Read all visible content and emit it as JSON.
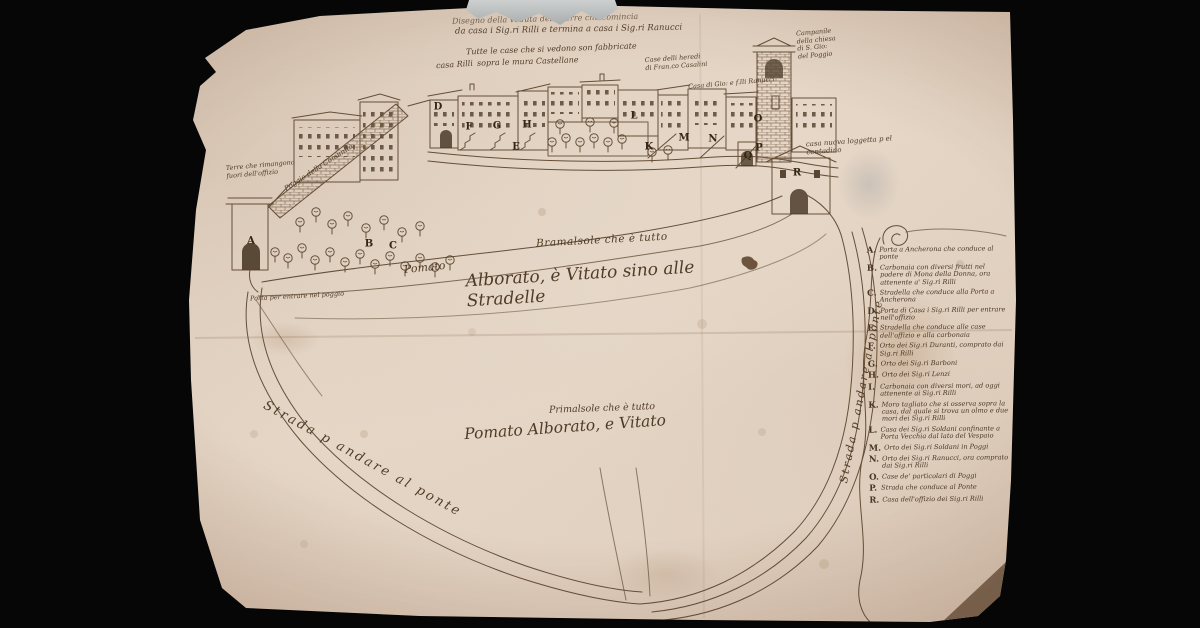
{
  "colors": {
    "background": "#060606",
    "paper": "#e6d8c9",
    "ink": "#5a432c"
  },
  "title": {
    "line1": "Disegno della veduta delle terre che comincia",
    "line2": "da casa i Sig.ri Rilli e termina a casa i Sig.ri Ranucci"
  },
  "annotations": [
    {
      "id": "title-1",
      "text": "Disegno della veduta delle terre che comincia",
      "style": "left:452px;top:13px;width:285px;font-size:8px;transform:rotate(-1.5deg);opacity:.75"
    },
    {
      "id": "title-2",
      "text": "da casa i Sig.ri Rilli e termina a casa i Sig.ri Ranucci",
      "style": "left:455px;top:24px;width:295px;font-size:8.5px;transform:rotate(-1deg)"
    },
    {
      "id": "casa-rilli",
      "text": "casa Rilli",
      "style": "left:436px;top:60px;font-size:8px;transform:rotate(-4deg)"
    },
    {
      "id": "mura-note-1",
      "text": "Tutte le case che si vedono son fabbricate",
      "style": "left:466px;top:44px;width:195px;font-size:8px;transform:rotate(-2deg)"
    },
    {
      "id": "mura-note-2",
      "text": "sopra le mura Castellane",
      "style": "left:477px;top:57px;font-size:8px;transform:rotate(-2deg)"
    },
    {
      "id": "case-heredi",
      "text": "Case delli heredi\ndi Fran.co Casalini",
      "style": "left:645px;top:54px;width:90px;font-size:6.5px;transform:rotate(-4deg)"
    },
    {
      "id": "casa-ranucci",
      "text": "Casa di Gio: e f.lli Ranucci",
      "style": "left:688px;top:78px;width:130px;font-size:6.5px;transform:rotate(-5deg)"
    },
    {
      "id": "campanile-note",
      "text": "Campanile\ndella chiesa\ndi S. Gio:\ndel Poggio",
      "style": "left:797px;top:28px;width:60px;font-size:6.5px;transform:rotate(-5deg)"
    },
    {
      "id": "loggetta-note",
      "text": "casa nuova loggetta p el\ncontadino",
      "style": "left:806px;top:136px;width:125px;font-size:7px;transform:rotate(-4deg)"
    },
    {
      "id": "fuori-note",
      "text": "Terre che rimangono\nfuori dell'offizio",
      "style": "left:226px;top:161px;width:95px;font-size:6.5px;transform:rotate(-5deg)"
    },
    {
      "id": "poggio-note",
      "text": "Poggio della Comunità",
      "style": "left:283px;top:186px;width:115px;font-size:7px;transform:rotate(-33deg);transform-origin:left top"
    },
    {
      "id": "porta-note",
      "text": "Porta per entrare nel poggio",
      "style": "left:250px;top:292px;width:135px;font-size:6.5px;transform:rotate(-3deg)"
    },
    {
      "id": "bramasole",
      "text": "Bramalsole che è tutto",
      "style": "left:536px;top:233px;width:175px;font-size:10.5px;letter-spacing:.5px;transform:rotate(-3deg)"
    },
    {
      "id": "pomato",
      "text": "Pomato",
      "style": "left:404px;top:262px;font-size:11px;transform:rotate(-6deg)"
    },
    {
      "id": "alborato",
      "text": "Alborato, è Vitato sino alle Stradelle",
      "style": "left:466px;top:263px;width:275px;font-size:17px;transform:rotate(-3.5deg)"
    },
    {
      "id": "primalsole",
      "text": "Primalsole che è tutto",
      "style": "left:549px;top:402px;width:160px;font-size:9.5px;transform:rotate(-2deg)"
    },
    {
      "id": "pomato-2",
      "text": "Pomato Alborato, e Vitato",
      "style": "left:464px;top:417px;width:235px;font-size:15.5px;transform:rotate(-4deg)"
    },
    {
      "id": "road-left",
      "text": "Strada p andare al ponte",
      "style": "left:268px;top:398px;width:250px;font-size:13px;letter-spacing:2.5px;transform:rotate(29deg);transform-origin:left top"
    },
    {
      "id": "road-right",
      "text": "Strada p andare al ponte",
      "style": "left:838px;top:482px;width:215px;font-size:11px;letter-spacing:2px;transform:rotate(-79deg);transform-origin:left top"
    }
  ],
  "map_letters": [
    {
      "label": "A",
      "style": "left:251px;top:241px"
    },
    {
      "label": "B",
      "style": "left:369px;top:244px"
    },
    {
      "label": "C",
      "style": "left:393px;top:246px"
    },
    {
      "label": "D",
      "style": "left:438px;top:107px"
    },
    {
      "label": "E",
      "style": "left:516px;top:147px"
    },
    {
      "label": "F",
      "style": "left:469px;top:127px"
    },
    {
      "label": "G",
      "style": "left:497px;top:126px"
    },
    {
      "label": "H",
      "style": "left:527px;top:125px"
    },
    {
      "label": "L",
      "style": "left:634px;top:116px"
    },
    {
      "label": "K",
      "style": "left:649px;top:147px"
    },
    {
      "label": "M",
      "style": "left:684px;top:138px"
    },
    {
      "label": "N",
      "style": "left:713px;top:139px"
    },
    {
      "label": "O",
      "style": "left:758px;top:119px"
    },
    {
      "label": "P",
      "style": "left:759px;top:148px"
    },
    {
      "label": "Q",
      "style": "left:748px;top:156px"
    },
    {
      "label": "R",
      "style": "left:797px;top:173px"
    }
  ],
  "legend": {
    "entries": [
      {
        "letter": "A.",
        "text": "Porta a Ancherona che conduce al ponte"
      },
      {
        "letter": "B.",
        "text": "Carbonaia con diversi frutti nel podere di Mona della Donna, ora attenente a' Sig.ri Rilli"
      },
      {
        "letter": "C.",
        "text": "Stradella che conduce alla Porta a Ancherona"
      },
      {
        "letter": "D.",
        "text": "Porta di Casa i Sig.ri Rilli per entrare nell'offizio"
      },
      {
        "letter": "E.",
        "text": "Stradella che conduce alle case dell'offizio e alla carbonaia"
      },
      {
        "letter": "F.",
        "text": "Orto dei Sig.ri Duranti, comprato dai Sig.ri Rilli"
      },
      {
        "letter": "G.",
        "text": "Orto dei Sig.ri Barboni"
      },
      {
        "letter": "H.",
        "text": "Orto dei Sig.ri Lenzi"
      },
      {
        "letter": "I.",
        "text": "Carbonaia con diversi mori, ad oggi attenente ai Sig.ri Rilli"
      },
      {
        "letter": "K.",
        "text": "Moro tagliato che si osserva sopra la casa, dal quale si trova un olmo e due mori dei Sig.ri Rilli"
      },
      {
        "letter": "L.",
        "text": "Casa dei Sig.ri Soldani confinante a Porta Vecchia dal lato del Vespaio"
      },
      {
        "letter": "M.",
        "text": "Orto dei Sig.ri Soldani in Poggi"
      },
      {
        "letter": "N.",
        "text": "Orto dei Sig.ri Ranucci, ora comprato dai Sig.ri Rilli"
      },
      {
        "letter": "O.",
        "text": "Case de' particolari di Poggi"
      },
      {
        "letter": "P.",
        "text": "Strada che conduce al Ponte"
      },
      {
        "letter": "R.",
        "text": "Casa dell'offizio dei Sig.ri Rilli"
      }
    ]
  }
}
